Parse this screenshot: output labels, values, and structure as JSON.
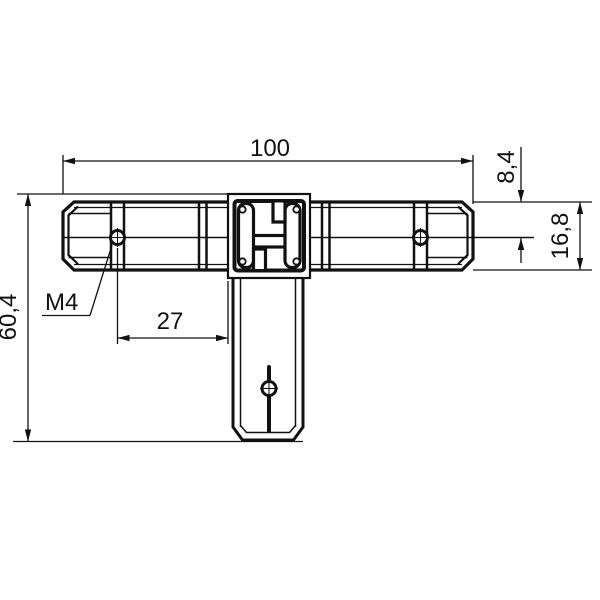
{
  "drawing": {
    "kind": "technical-drawing-t-connector",
    "background": "#ffffff",
    "line_color": "#111111",
    "dims": {
      "overall_width": "100",
      "hole_offset_from_top": "8,4",
      "profile_height": "16,8",
      "overall_height": "60,4",
      "hole_to_block": "27",
      "thread_callout": "M4"
    }
  }
}
